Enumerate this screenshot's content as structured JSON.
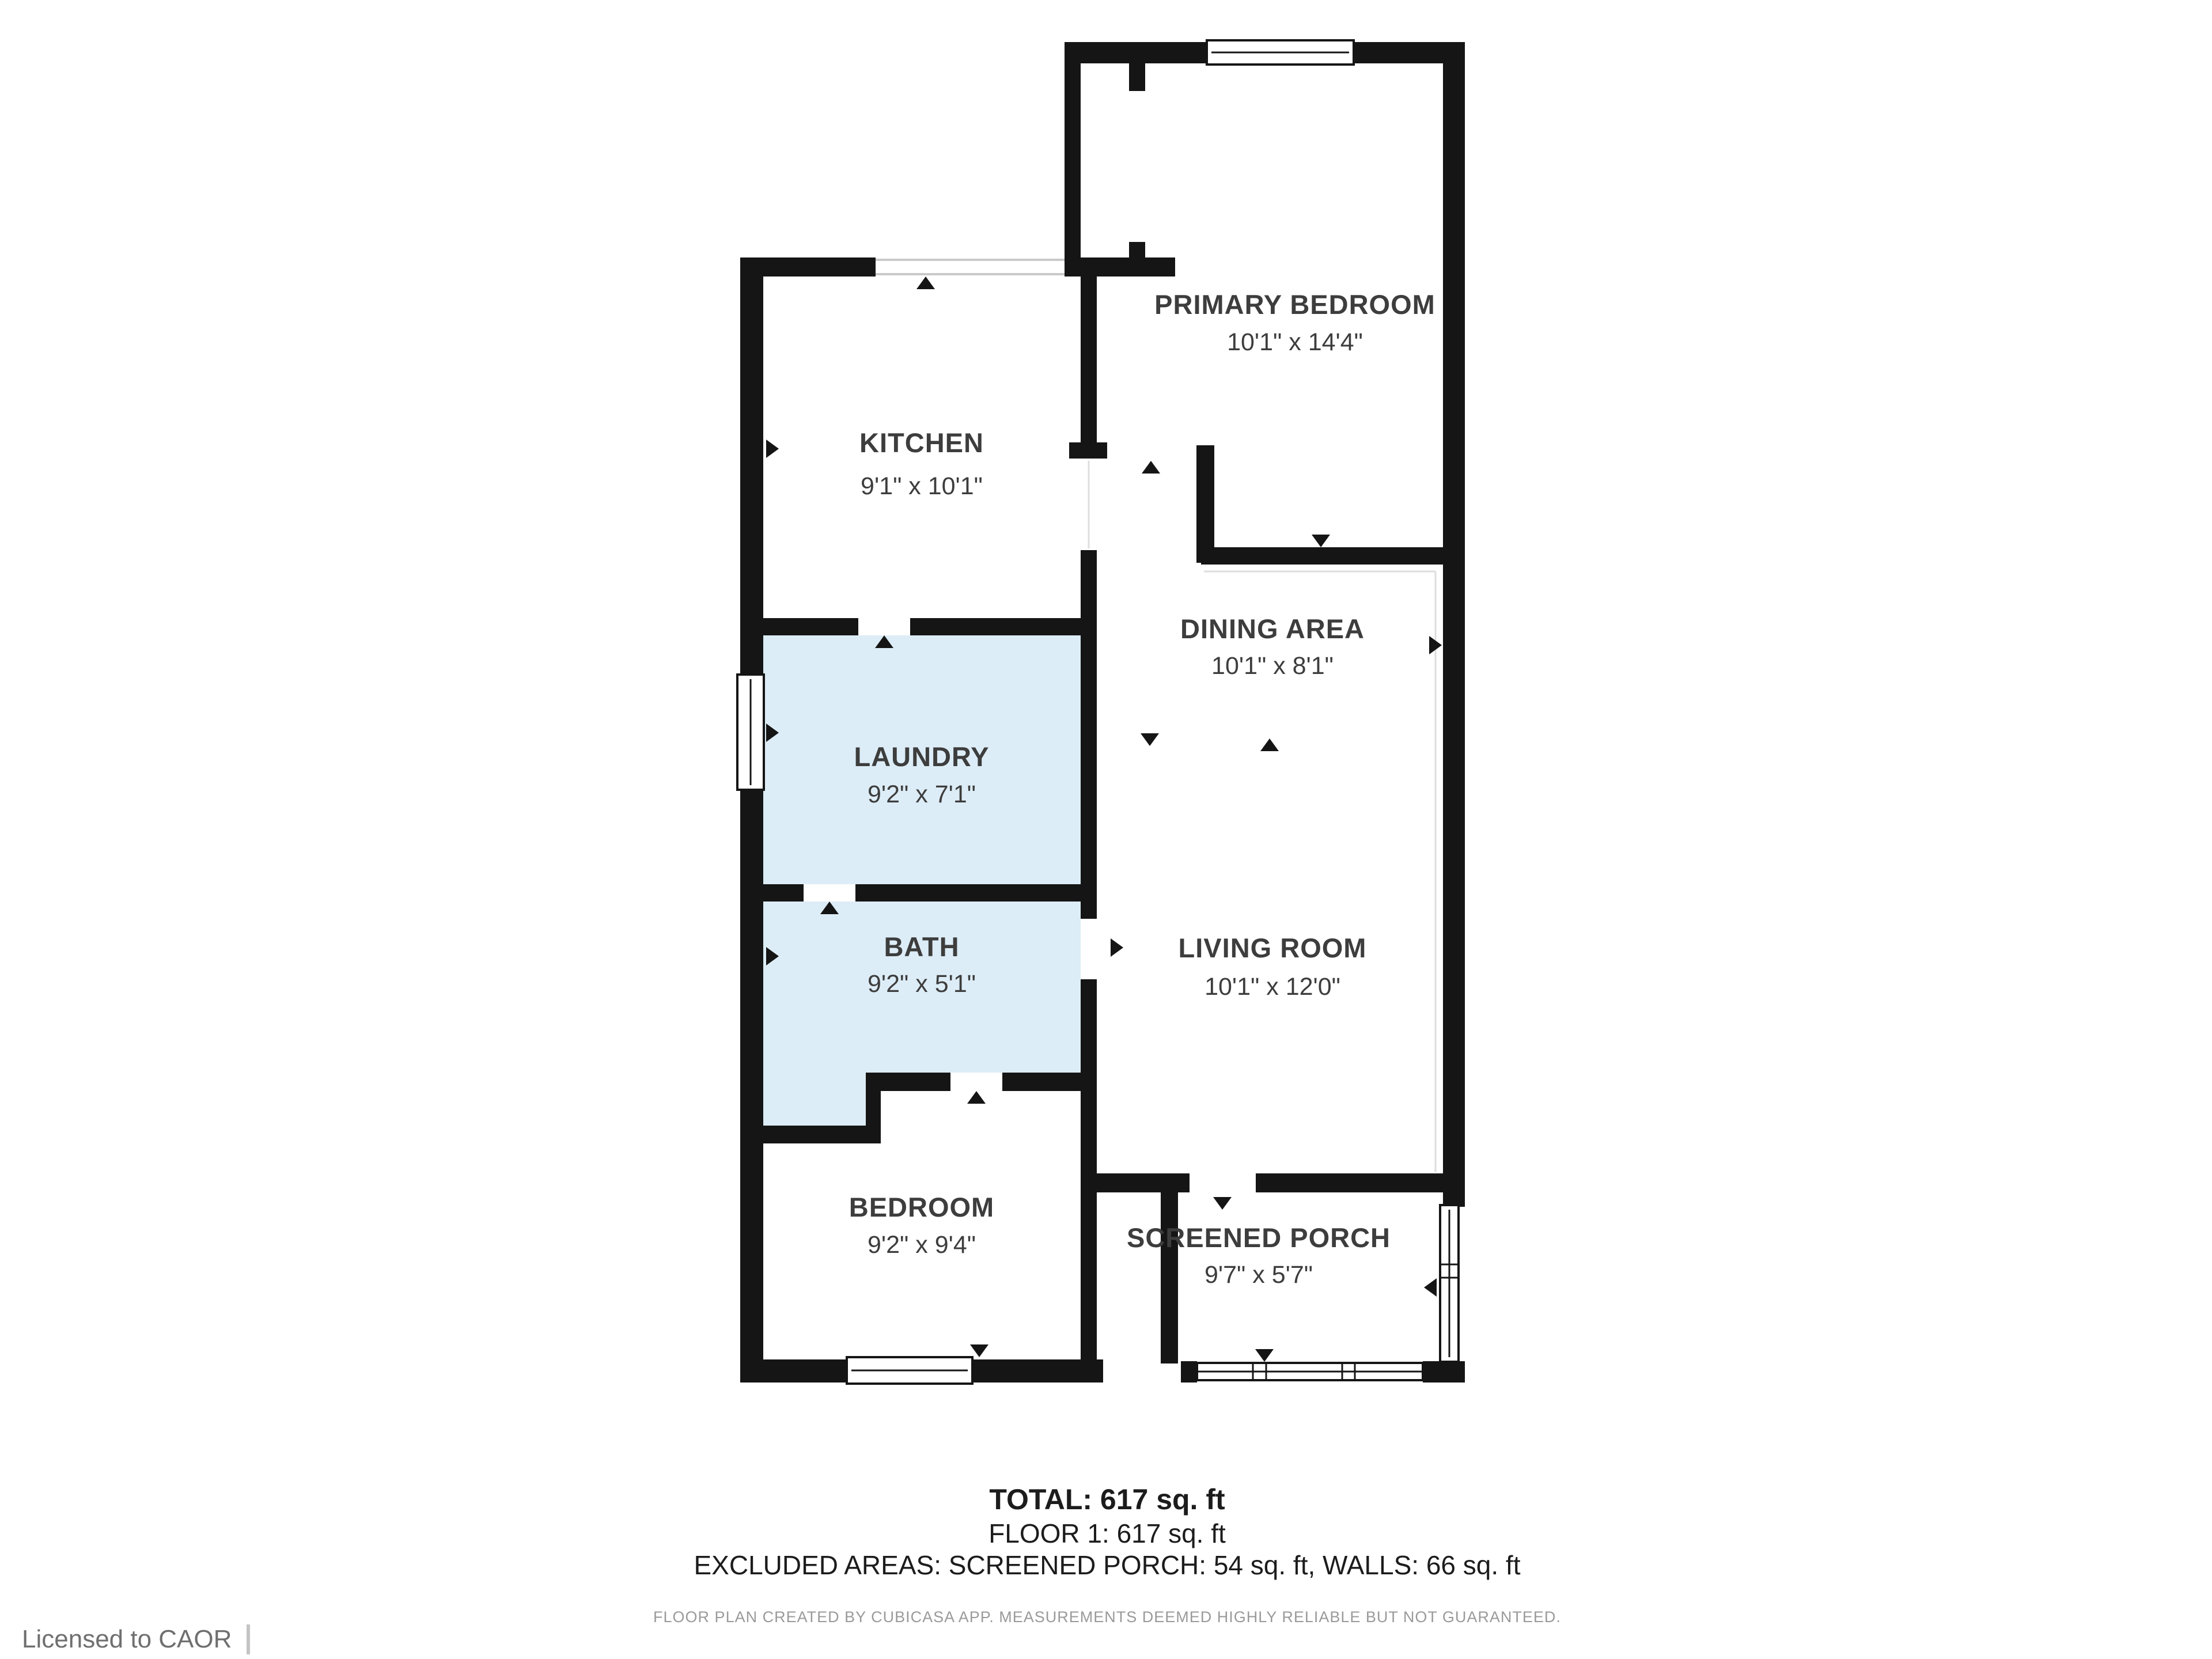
{
  "meta": {
    "app": "floor-plan-viewer"
  },
  "colors": {
    "wall": "#151515",
    "wet_room_fill": "#ddedf7",
    "label": "#3d3d3d",
    "fine_print": "#9a9a9a",
    "footer_text": "#6f6f6f"
  },
  "rooms": {
    "kitchen": {
      "name": "KITCHEN",
      "dims": "9'1\" x 10'1\""
    },
    "laundry": {
      "name": "LAUNDRY",
      "dims": "9'2\" x 7'1\""
    },
    "bath": {
      "name": "BATH",
      "dims": "9'2\" x 5'1\""
    },
    "bedroom": {
      "name": "BEDROOM",
      "dims": "9'2\" x 9'4\""
    },
    "primary_bedroom": {
      "name": "PRIMARY BEDROOM",
      "dims": "10'1\" x 14'4\""
    },
    "dining": {
      "name": "DINING AREA",
      "dims": "10'1\" x 8'1\""
    },
    "living": {
      "name": "LIVING ROOM",
      "dims": "10'1\" x 12'0\""
    },
    "porch": {
      "name": "SCREENED PORCH",
      "dims": "9'7\" x 5'7\""
    }
  },
  "summary": {
    "total": "TOTAL: 617 sq. ft",
    "floor": "FLOOR 1: 617 sq. ft",
    "excluded": "EXCLUDED AREAS: SCREENED PORCH: 54 sq. ft, WALLS: 66 sq. ft"
  },
  "fine_print": "FLOOR PLAN CREATED BY CUBICASA APP. MEASUREMENTS DEEMED HIGHLY RELIABLE BUT NOT GUARANTEED.",
  "footer": {
    "license": "Licensed to CAOR"
  }
}
